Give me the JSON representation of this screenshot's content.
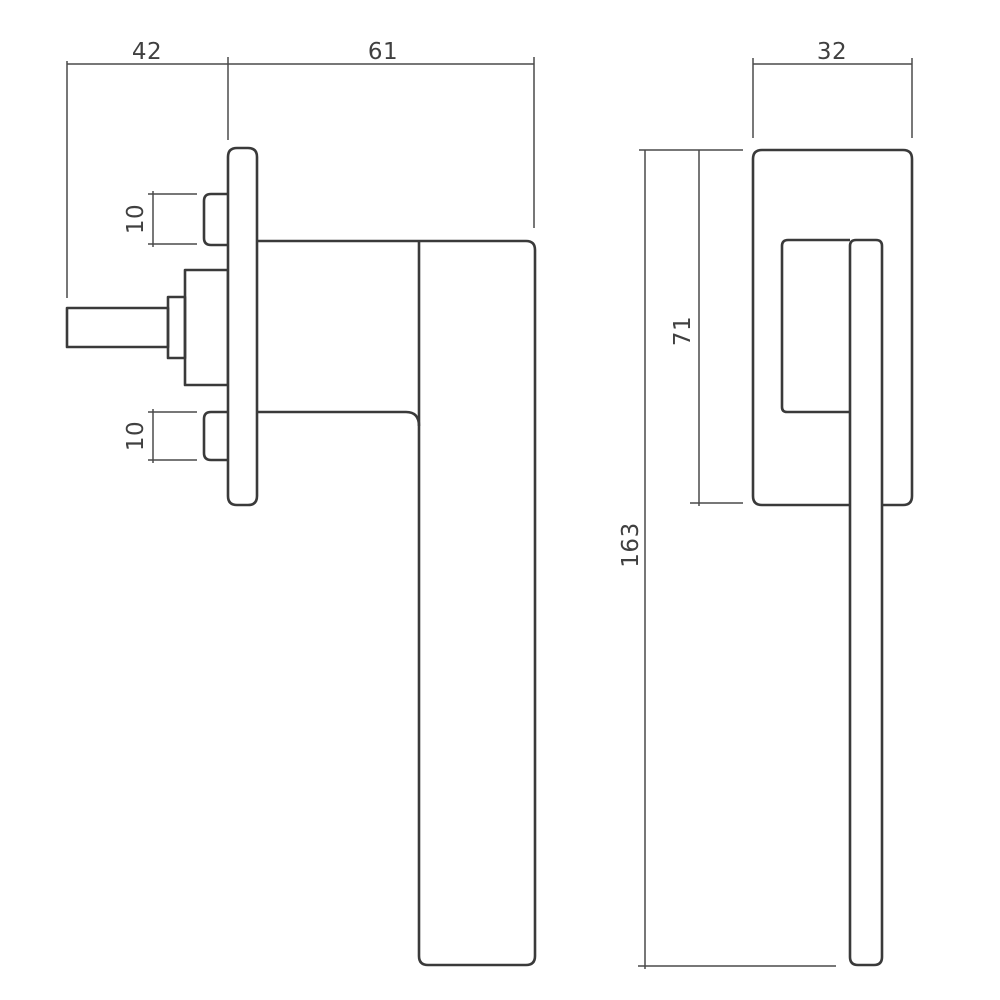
{
  "diagram": {
    "subject": "window-handle-technical-drawing",
    "background": "#ffffff",
    "object_line_color": "#3a3a3a",
    "dimension_line_color": "#4a4a4a",
    "label_color": "#404040",
    "side_view": {
      "spindle_to_plate": "42",
      "plate_to_grip_front": "61",
      "screw_boss_upper": "10",
      "screw_boss_lower": "10"
    },
    "front_view": {
      "rose_width": "32",
      "rose_height": "71",
      "overall_height": "163"
    }
  }
}
